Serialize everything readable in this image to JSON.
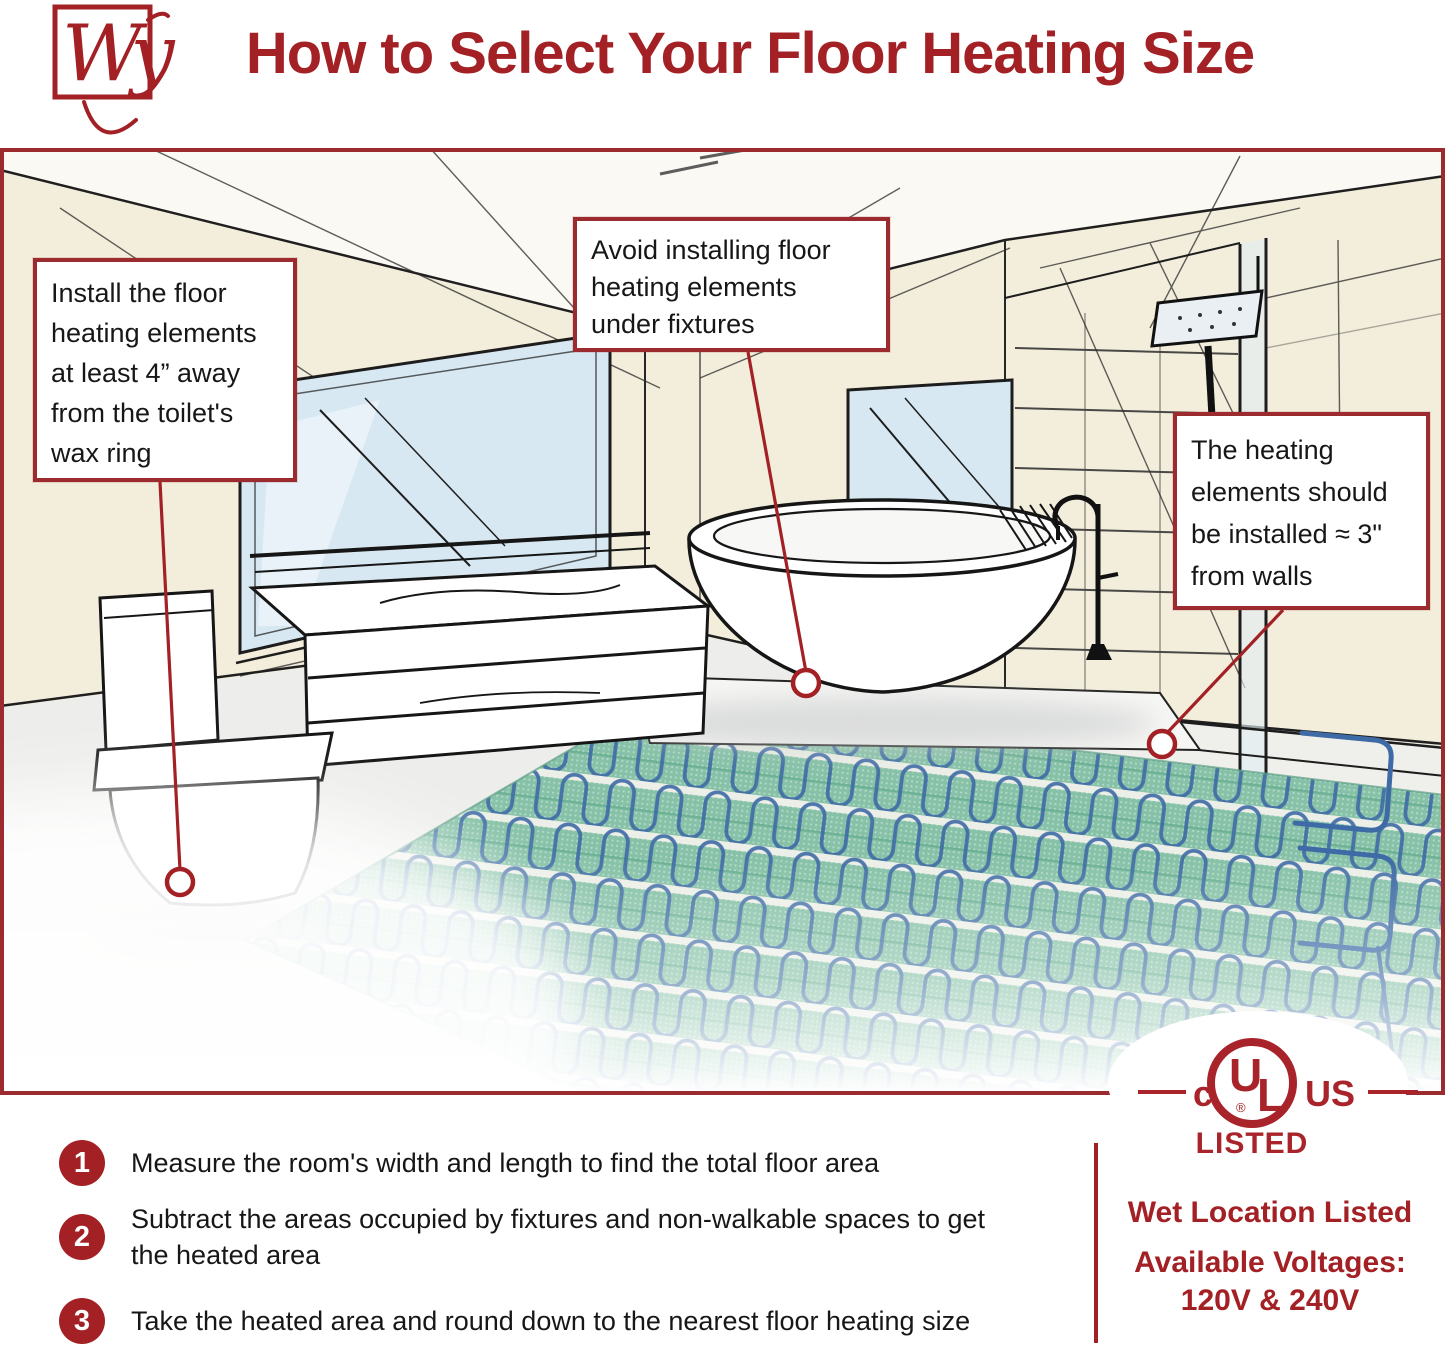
{
  "header": {
    "logo": "Wy",
    "title": "How to Select Your Floor Heating Size"
  },
  "callouts": {
    "toilet": {
      "lines": [
        "Install the floor",
        "heating elements",
        "at least 4” away",
        "from the toilet's",
        "wax ring"
      ]
    },
    "fixtures": {
      "lines": [
        "Avoid installing floor",
        "heating elements",
        "under fixtures"
      ]
    },
    "walls": {
      "lines": [
        "The heating",
        "elements should",
        "be installed ≈ 3\"",
        "from walls"
      ]
    }
  },
  "steps": [
    {
      "number": "1",
      "text": "Measure the room's width and length to find the total floor area"
    },
    {
      "number": "2",
      "text": "Subtract the areas occupied by fixtures and non-walkable spaces to get the heated area"
    },
    {
      "number": "3",
      "text": "Take the heated area and round down to the nearest floor heating size"
    }
  ],
  "certification": {
    "c_mark": "c",
    "monogram_u": "U",
    "monogram_l": "L",
    "registered": "®",
    "us_mark": "US",
    "listed": "LISTED",
    "wet_location": "Wet Location Listed",
    "voltages_label": "Available Voltages:",
    "voltages_value": "120V & 240V"
  },
  "colors": {
    "accent_red": "#A32025",
    "border_red": "#9B2B2E",
    "text_black": "#171717",
    "wall_cream": "#F3EEDC",
    "glass_blue": "#D8E8F2",
    "mat_green": "#87C2A8",
    "cable_blue": "#3E6BA6"
  }
}
